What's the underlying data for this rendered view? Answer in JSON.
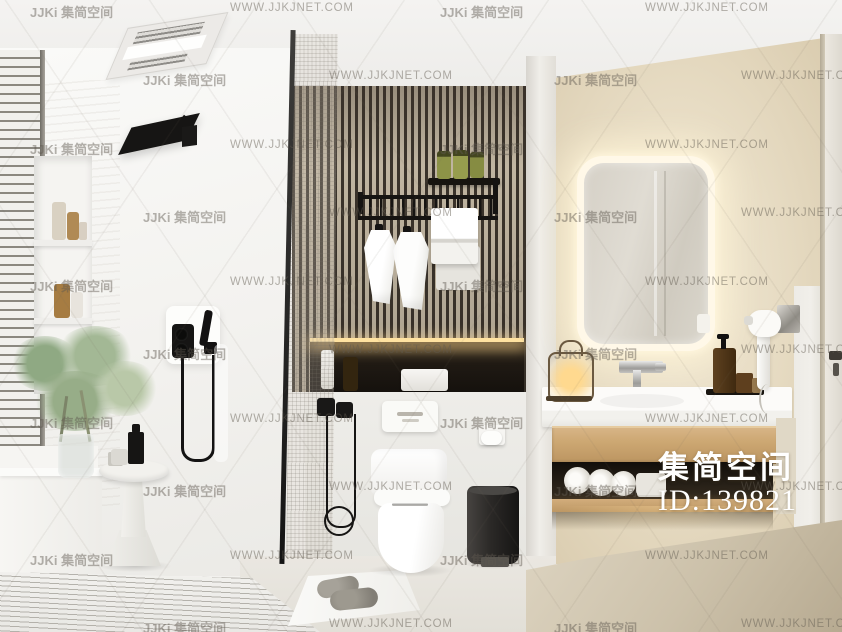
{
  "watermarks": {
    "site_text": "WWW.JJKJNET.COM",
    "brand_text": "JJKi 集简空间",
    "big_brand": "集简空间",
    "big_id": "ID:139821",
    "grid": [
      {
        "x": 30,
        "y": 2,
        "t": "brand"
      },
      {
        "x": 230,
        "y": 2,
        "t": "site"
      },
      {
        "x": 440,
        "y": 2,
        "t": "brand"
      },
      {
        "x": 645,
        "y": 2,
        "t": "site"
      },
      {
        "x": 143,
        "y": 70,
        "t": "brand"
      },
      {
        "x": 329,
        "y": 70,
        "t": "site"
      },
      {
        "x": 554,
        "y": 70,
        "t": "brand"
      },
      {
        "x": 741,
        "y": 70,
        "t": "site"
      },
      {
        "x": 30,
        "y": 139,
        "t": "brand"
      },
      {
        "x": 230,
        "y": 139,
        "t": "site"
      },
      {
        "x": 440,
        "y": 139,
        "t": "brand"
      },
      {
        "x": 645,
        "y": 139,
        "t": "site"
      },
      {
        "x": 143,
        "y": 207,
        "t": "brand"
      },
      {
        "x": 329,
        "y": 207,
        "t": "site"
      },
      {
        "x": 554,
        "y": 207,
        "t": "brand"
      },
      {
        "x": 741,
        "y": 207,
        "t": "site"
      },
      {
        "x": 30,
        "y": 276,
        "t": "brand"
      },
      {
        "x": 230,
        "y": 276,
        "t": "site"
      },
      {
        "x": 440,
        "y": 276,
        "t": "brand"
      },
      {
        "x": 645,
        "y": 276,
        "t": "site"
      },
      {
        "x": 143,
        "y": 344,
        "t": "brand"
      },
      {
        "x": 329,
        "y": 344,
        "t": "site"
      },
      {
        "x": 554,
        "y": 344,
        "t": "brand"
      },
      {
        "x": 741,
        "y": 344,
        "t": "site"
      },
      {
        "x": 30,
        "y": 413,
        "t": "brand"
      },
      {
        "x": 230,
        "y": 413,
        "t": "site"
      },
      {
        "x": 440,
        "y": 413,
        "t": "brand"
      },
      {
        "x": 645,
        "y": 413,
        "t": "site"
      },
      {
        "x": 143,
        "y": 481,
        "t": "brand"
      },
      {
        "x": 329,
        "y": 481,
        "t": "site"
      },
      {
        "x": 554,
        "y": 481,
        "t": "brand"
      },
      {
        "x": 741,
        "y": 481,
        "t": "site"
      },
      {
        "x": 30,
        "y": 550,
        "t": "brand"
      },
      {
        "x": 230,
        "y": 550,
        "t": "site"
      },
      {
        "x": 440,
        "y": 550,
        "t": "brand"
      },
      {
        "x": 645,
        "y": 550,
        "t": "site"
      },
      {
        "x": 143,
        "y": 618,
        "t": "brand"
      },
      {
        "x": 329,
        "y": 618,
        "t": "site"
      },
      {
        "x": 554,
        "y": 618,
        "t": "brand"
      },
      {
        "x": 741,
        "y": 618,
        "t": "site"
      }
    ]
  },
  "palette": {
    "ceiling": "#f3f2f0",
    "wall_white": "#f6f5f2",
    "wall_cream": "#e7dcc4",
    "slat_dark": "#3a332b",
    "slat_light": "#c0b5a1",
    "wood": "#cda873",
    "shelf_dark": "#241e16",
    "counter_white": "#fbfaf8",
    "floor_center": "#e9e6e0",
    "floor_right": "#cdc2ab",
    "fixture_black": "#151413",
    "led_glow": "#fff6dd",
    "niche_led": "#ffe2a0",
    "bin_dark": "#2c2a28",
    "watermark_gray": "rgba(96,90,80,0.47)",
    "watermark_white": "#ffffff"
  }
}
